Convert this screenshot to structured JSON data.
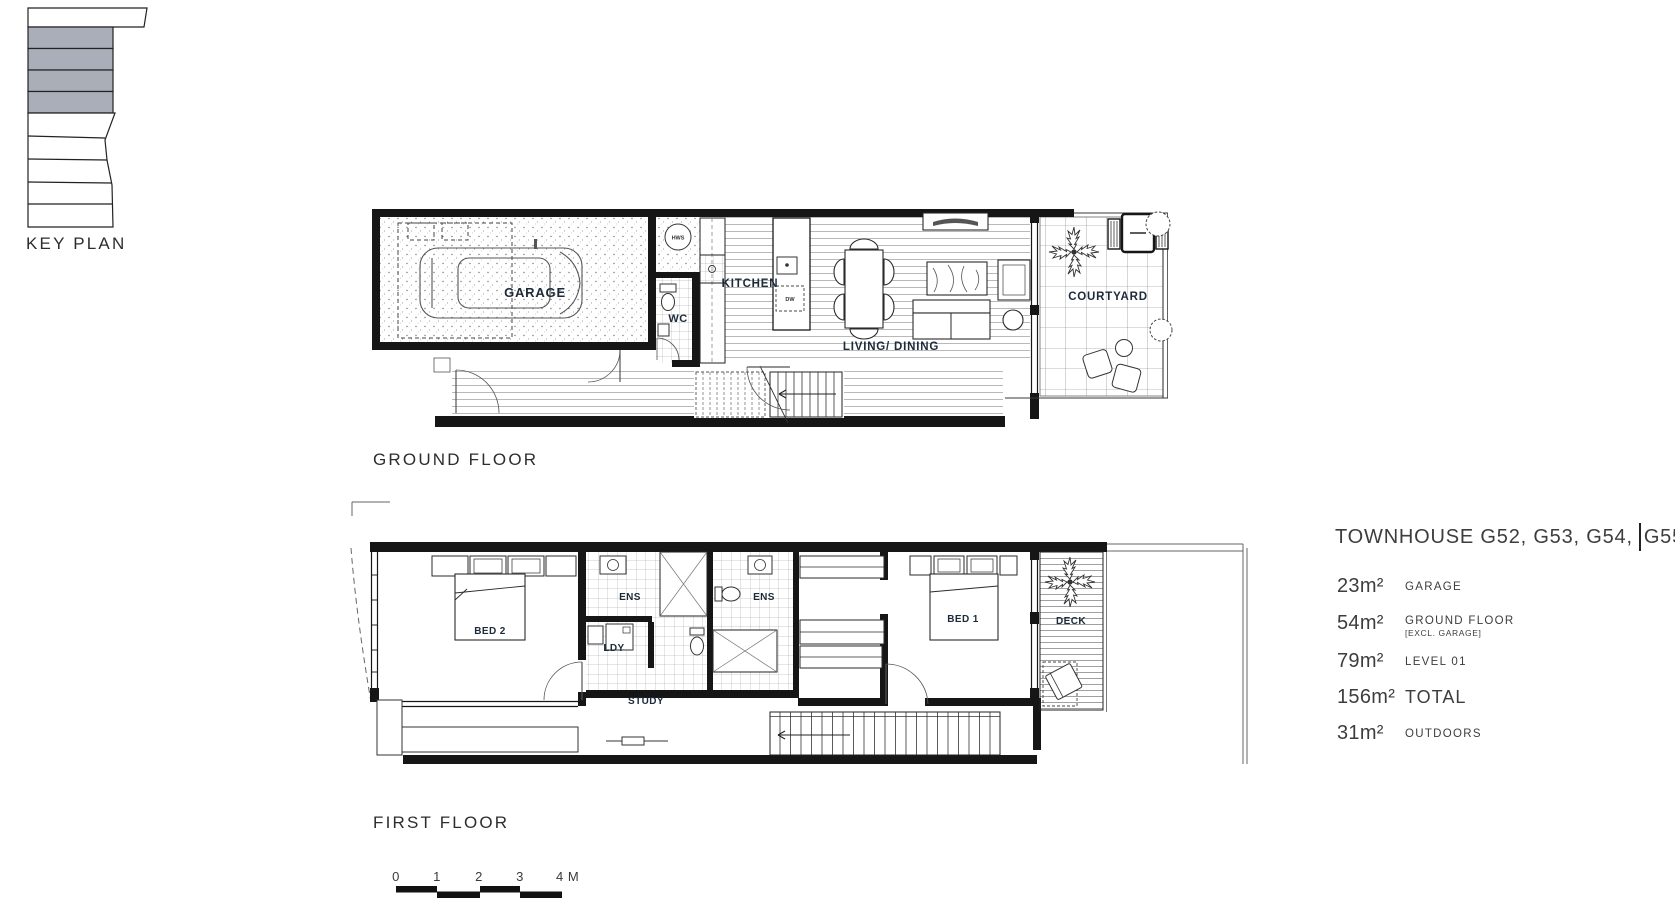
{
  "key_plan": {
    "label": "KEY PLAN"
  },
  "ground_floor": {
    "caption": "GROUND FLOOR",
    "rooms": {
      "garage": "GARAGE",
      "wc": "WC",
      "kitchen": "KITCHEN",
      "living_dining": "LIVING/ DINING",
      "courtyard": "COURTYARD"
    },
    "annotations": {
      "hws": "HWS",
      "dw": "DW"
    }
  },
  "first_floor": {
    "caption": "FIRST FLOOR",
    "rooms": {
      "bed2": "BED 2",
      "ens_left": "ENS",
      "ldy": "LDY",
      "ens_right": "ENS",
      "bed1": "BED 1",
      "study": "STUDY",
      "deck": "DECK"
    }
  },
  "scale_bar": {
    "ticks": [
      "0",
      "1",
      "2",
      "3"
    ],
    "end_label": "4 M"
  },
  "title_block": {
    "title_left": "TOWNHOUSE G52, G53, G54,",
    "title_right": "G55",
    "areas": [
      {
        "value": "23m²",
        "label": "GARAGE",
        "note": ""
      },
      {
        "value": "54m²",
        "label": "GROUND FLOOR",
        "note": "[EXCL. GARAGE]"
      },
      {
        "value": "79m²",
        "label": "LEVEL 01",
        "note": ""
      },
      {
        "value": "156m²",
        "label": "TOTAL",
        "note": ""
      },
      {
        "value": "31m²",
        "label": "OUTDOORS",
        "note": ""
      }
    ]
  },
  "colors": {
    "ink": "#161616",
    "room_label": "#1c2a3a",
    "shade": "#a9aeb9"
  }
}
